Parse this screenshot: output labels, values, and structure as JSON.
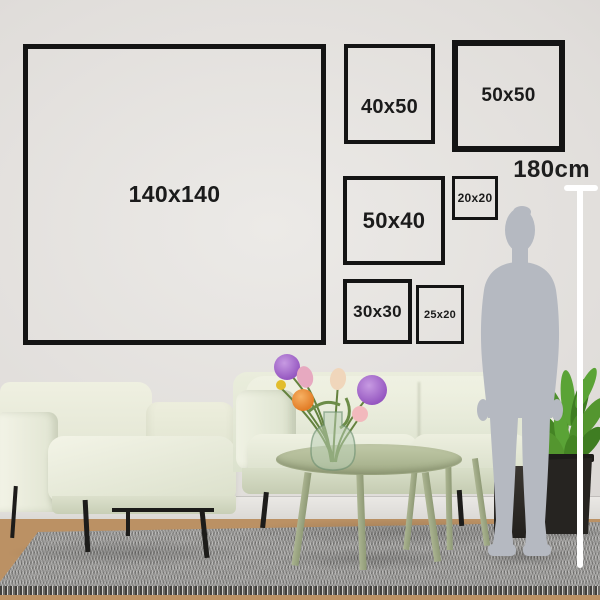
{
  "frames": [
    {
      "name": "140x140",
      "label": "140x140"
    },
    {
      "name": "40x50",
      "label": "40x50"
    },
    {
      "name": "50x50",
      "label": "50x50"
    },
    {
      "name": "50x40",
      "label": "50x40"
    },
    {
      "name": "20x20",
      "label": "20x20"
    },
    {
      "name": "30x30",
      "label": "30x30"
    },
    {
      "name": "25x20",
      "label": "25x20"
    }
  ],
  "measure": {
    "height_label": "180cm"
  },
  "colors": {
    "wall": "#e0ddda",
    "floor": "#bb9164",
    "rug": "#9e9d9b",
    "frame_border": "#141414",
    "label_text": "#1b1b1b",
    "sofa": "#e5e9d7",
    "armchair": "#eff0e1",
    "table": "#a9b293",
    "silhouette": "#b5b9c1",
    "measure_line": "#ffffff",
    "plant_leaf": "#4d8f2c",
    "plant_pot": "#262421",
    "flower_purple": "#a76bca",
    "flower_orange": "#ee9340",
    "flower_pink": "#e7a9c0",
    "flower_yellow": "#e2bd2c"
  }
}
